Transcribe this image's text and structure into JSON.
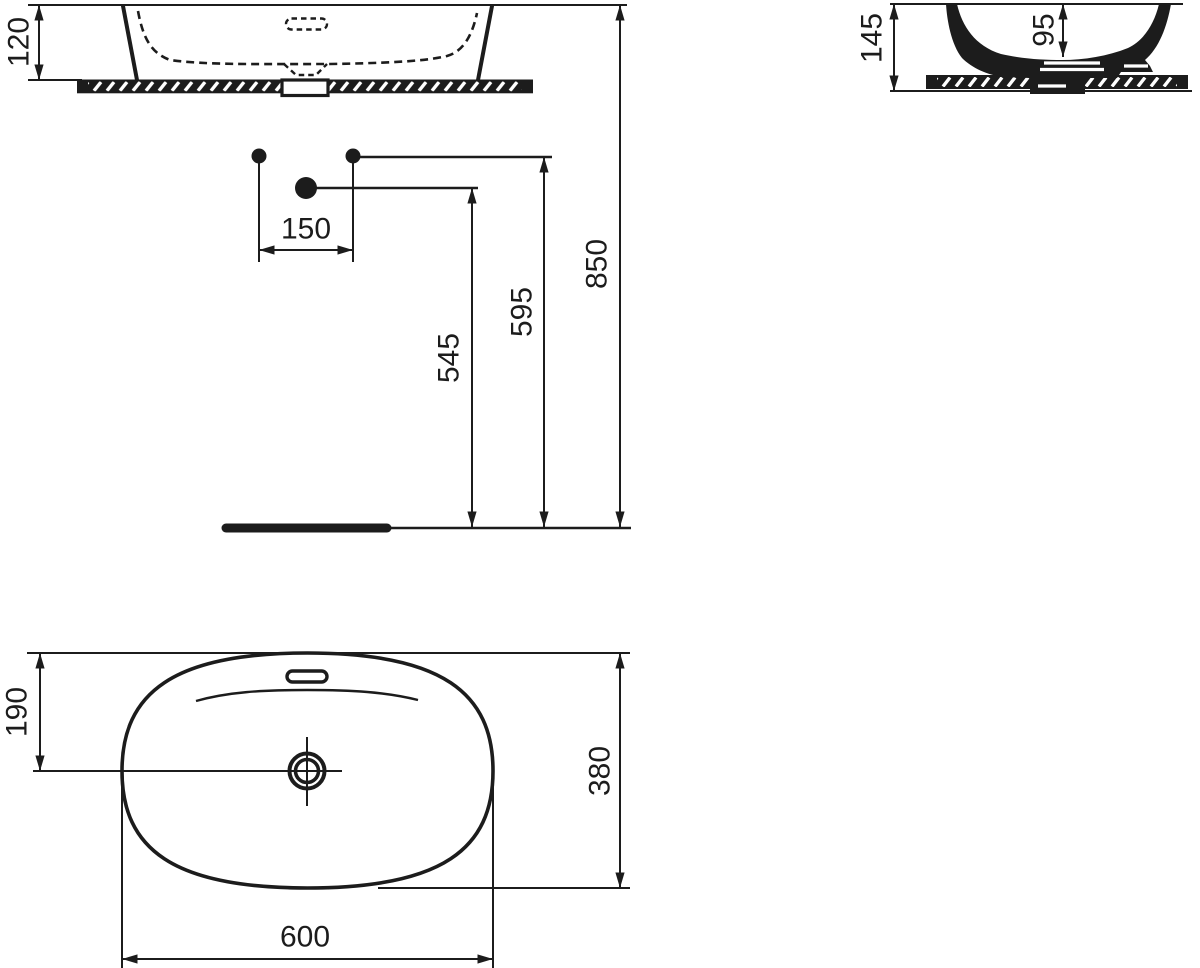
{
  "page": {
    "background": "#ffffff",
    "line_color": "#1c1c1c",
    "description": "Technical dimension drawing of an oval countertop washbasin: front elevation, side section, installation heights and top plan view",
    "units": "mm"
  },
  "dimensions": {
    "basin_height_above_counter": "120",
    "total_section_height": "145",
    "inner_bowl_depth": "95",
    "faucet_hole_spacing": "150",
    "height_spout_reference": "545",
    "height_faucet_holes": "595",
    "height_rim_above_floor": "850",
    "drain_center_offset": "190",
    "basin_depth": "380",
    "basin_width": "600"
  }
}
